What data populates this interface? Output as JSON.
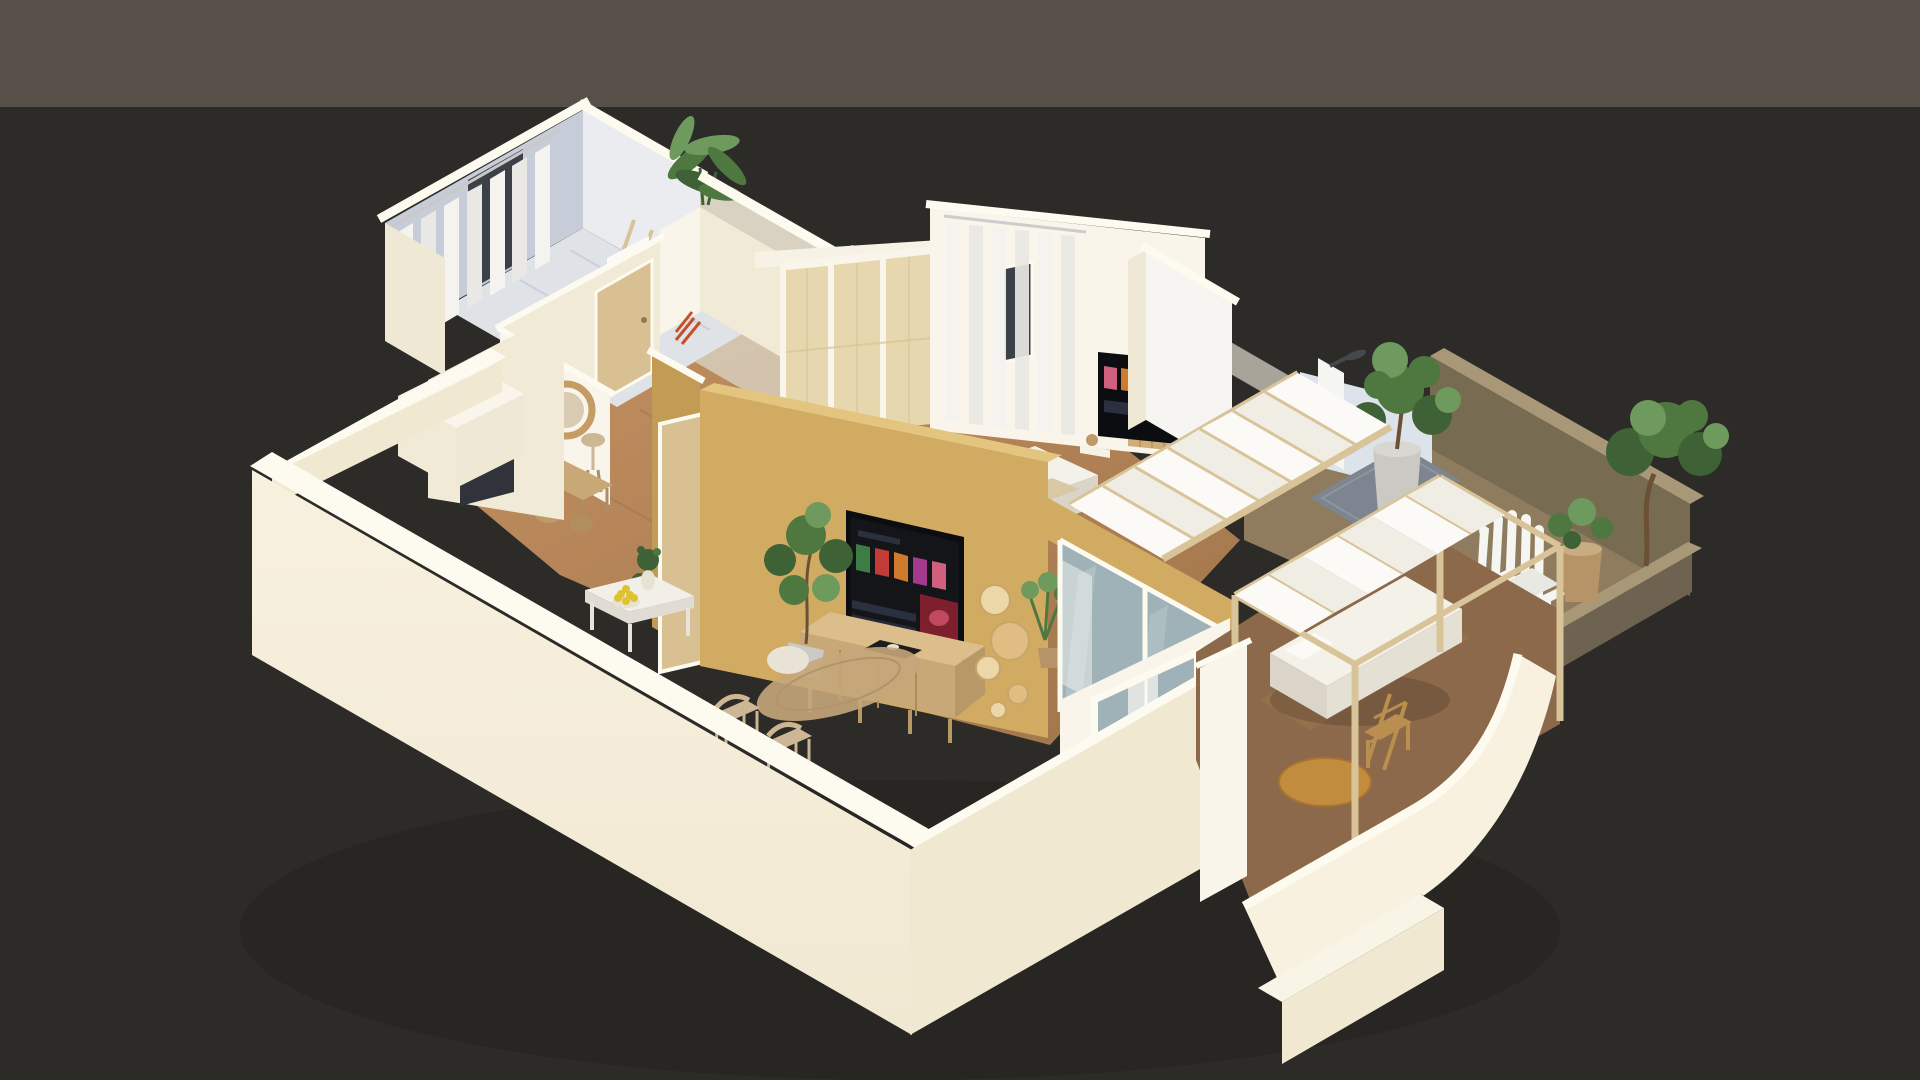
{
  "scene": {
    "type": "isometric-cutaway-apartment-render",
    "camera": "isometric",
    "background": {
      "band_split_y": 107
    },
    "rooms": [
      {
        "name": "bathroom",
        "items": [
          "sheer-curtains",
          "window",
          "towel-ladder",
          "banana-plant",
          "walk-in-shower",
          "sink-counter"
        ]
      },
      {
        "name": "bedroom",
        "items": [
          "cane-wardrobe",
          "sheer-curtains",
          "window",
          "wall-tv",
          "wood-slat-panel",
          "double-bed",
          "floating-shelf"
        ]
      },
      {
        "name": "entry-hall",
        "items": [
          "rattan-mirror",
          "wood-bench",
          "wicker-baskets",
          "stool-lamp",
          "oak-door"
        ]
      },
      {
        "name": "living-room",
        "items": [
          "mustard-accent-wall",
          "smart-tv",
          "media-sideboard",
          "ficus-plant",
          "wood-wall-discs",
          "jute-rug",
          "pouf"
        ]
      },
      {
        "name": "dining-area",
        "items": [
          "white-table",
          "flower-vase",
          "lemon-bowl",
          "wood-chairs",
          "potted-plant"
        ]
      },
      {
        "name": "balcony",
        "items": [
          "sliding-glass-doors",
          "glass-railing",
          "pergola-canopy"
        ]
      },
      {
        "name": "covered-terrace",
        "items": [
          "pergola-frame",
          "fabric-canopy",
          "daybed",
          "wood-chair",
          "round-coffee-table"
        ]
      },
      {
        "name": "open-terrace",
        "items": [
          "adirondack-chair",
          "outdoor-shower",
          "shower-mat",
          "potted-trees",
          "concrete-parapet"
        ]
      }
    ]
  },
  "palette": {
    "bg_top": "#575049",
    "bg_bottom": "#2c2b27",
    "shadow": "#1f1e1a",
    "wall_top": "#fdfaf0",
    "wall_cream": "#f8f1df",
    "wall_cream_dark": "#f1e8d2",
    "wall_bright": "#f9f5ea",
    "wall_interior": "#f1ead7",
    "wall_white": "#f6f5f1",
    "wall_end": "#efe8d4",
    "soffit": "#f6f2e6",
    "beige_wall": "#d9d2c2",
    "blue_wall": "#c6cdd8",
    "blue_wall_light": "#eaecef",
    "blue_floor": "#dfe2e6",
    "bluegray_wall": "#dde3ea",
    "concrete": "#a8a49a",
    "olive_wall": "#776b52",
    "olive_dark": "#6e6350",
    "olive_top": "#a99878",
    "terrace_floor": "#8f7c5e",
    "terrace_floor_low": "#8c694a",
    "terrace_streak": "#a07a52",
    "wood_floor_light": "#c18f61",
    "wood_floor_dark": "#a0744a",
    "plank_line": "#8a6140",
    "wood_door": "#d8c092",
    "cane": "#e7d7ae",
    "slat_wood": "#cfae77",
    "slat_line": "#b99a66",
    "tan_wall": "#d2ab63",
    "tan_top": "#e3c580",
    "tan_shade": "#c29b55",
    "tv_dark": "#0c0d10",
    "screen_bg": "#141519",
    "screen_panel": "#2a3040",
    "poster_green": "#3c7d46",
    "poster_red": "#c23b37",
    "poster_orange": "#cf7a2c",
    "poster_purple": "#a43a8e",
    "poster_pink": "#d0607e",
    "hero_red": "#7e1f2e",
    "hero_glow": "#c0485f",
    "tv_stand": "#1a1a1a",
    "tray": "#1f1d1a",
    "deco_white": "#e8e2d2",
    "console_wood": "#c9a878",
    "console_top": "#dcbd8c",
    "console_side": "#b99868",
    "drawer_line": "#ad8c5c",
    "beam_wood": "#d9c49a",
    "canopy": "#fbfaf6",
    "canopy_shade": "#f0eee4",
    "glass": "#9fb2b8",
    "glass_rail": "#b9c4bf",
    "mattress": "#f4f1e9",
    "mattress_side": "#e4e0d4",
    "mattress_dark": "#dad5c8",
    "throw": "#d9c8a4",
    "curtain": "#f4f3f0",
    "curtain_shade": "#e9e8e4",
    "rod": "#c9c9c9",
    "window_dark": "#3c4148",
    "appliance": "#30343a",
    "mirror_rattan": "#c49c64",
    "mirror_face": "#d8cbb2",
    "basket": "#c09a66",
    "basket_dark": "#b38e5d",
    "bench_leg": "#a98f68",
    "lamp": "#cdb896",
    "accent_red": "#c4502a",
    "plant_dark": "#3f6136",
    "plant_mid": "#4e7840",
    "plant_light": "#6f9a5e",
    "trunk": "#6b5034",
    "pot_gray": "#cbc9c4",
    "pot_gray_light": "#d9d7d2",
    "pot_tan": "#b79468",
    "pot_tan_light": "#c9ad82",
    "disc_light": "#ecd7a8",
    "disc_mid": "#dfbd83",
    "rug": "#c5a67a",
    "rug_ring": "#b3946a",
    "pouf": "#e9e3d6",
    "table_white": "#f2efe8",
    "table_side": "#e0dcd3",
    "table_leg": "#e8e4da",
    "lemon": "#ddc32f",
    "chair_wood": "#cdb693",
    "wood_chair2": "#b98e4f",
    "wood_table_top": "#c28c3e",
    "wood_table_rim": "#a87430",
    "chair_white": "#f5f5f2",
    "chair_white_shade": "#e9e9e4",
    "mat_gray": "#7d8590",
    "mat_line": "#8d95a0",
    "step_cream": "#f8f4e6",
    "sink": "#eceae4",
    "fixture_dark": "#44484d",
    "knob": "#8a7a55"
  }
}
